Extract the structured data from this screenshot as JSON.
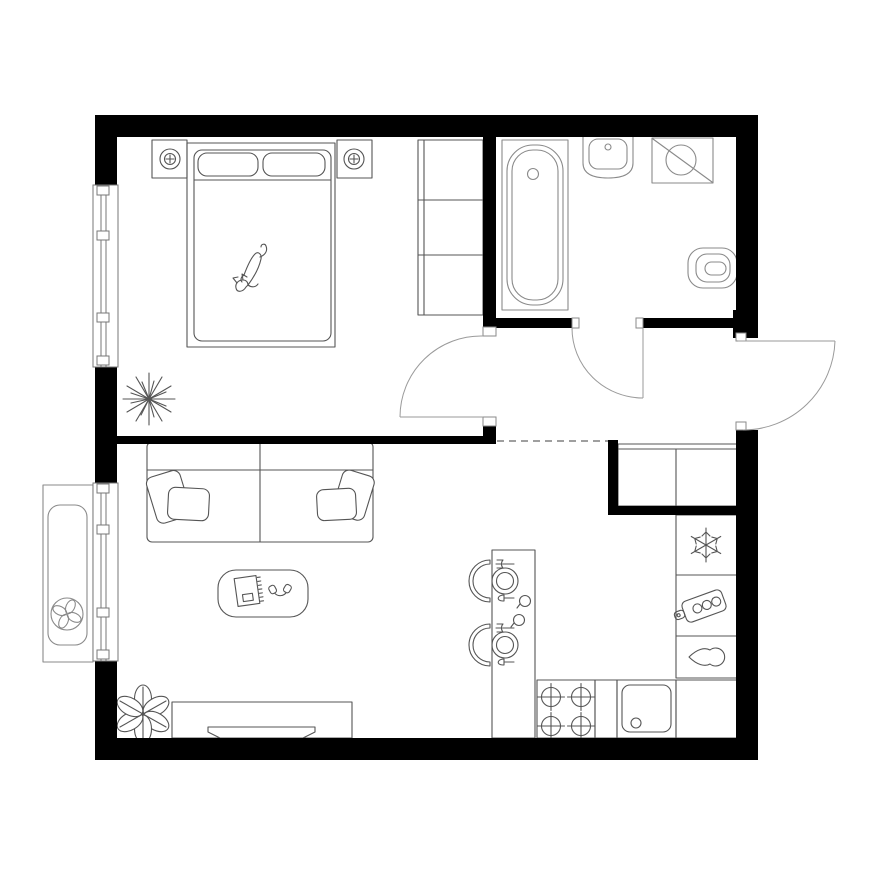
{
  "canvas": {
    "width": 880,
    "height": 880
  },
  "colors": {
    "background": "#ffffff",
    "wall": "#000000",
    "furniture-line": "#555555",
    "fixture-line": "#8a8a8a",
    "door-line": "#9a9a9a",
    "dash-line": "#666666",
    "window-line": "#777777"
  },
  "floorplan": {
    "type": "apartment-floor-plan",
    "rooms": [
      {
        "name": "bedroom",
        "items": [
          "double-bed",
          "pillows",
          "cat",
          "nightstand-left",
          "nightstand-right",
          "lamp-icon",
          "wardrobe",
          "spiky-plant",
          "window"
        ]
      },
      {
        "name": "bathroom",
        "items": [
          "bathtub",
          "wash-basin",
          "washing-machine-icon",
          "toilet",
          "bathroom-door"
        ]
      },
      {
        "name": "hallway",
        "items": [
          "entrance-door",
          "bedroom-door",
          "built-in-closet",
          "dashed-threshold"
        ]
      },
      {
        "name": "living-room",
        "items": [
          "sofa",
          "sofa-pillows",
          "coffee-table",
          "notebook",
          "headphones",
          "tv-stand",
          "tv",
          "leafy-plant",
          "window"
        ]
      },
      {
        "name": "kitchen",
        "items": [
          "bar-counter",
          "place-settings",
          "glasses",
          "bar-chairs",
          "stove",
          "burner-icon",
          "kitchen-sink",
          "snowflake-icon",
          "cutting-board-icon",
          "water-drop-icon"
        ]
      },
      {
        "name": "balcony",
        "items": [
          "ac-unit",
          "fan-icon"
        ]
      }
    ],
    "doors": [
      "bedroom-door",
      "bathroom-door",
      "entrance-door"
    ],
    "windows": [
      "bedroom-window",
      "living-room-window"
    ],
    "icons": [
      "lamp-icon",
      "washing-machine-icon",
      "fan-icon",
      "snowflake-icon",
      "cutting-board-icon",
      "water-drop-icon",
      "burner-icon"
    ]
  }
}
